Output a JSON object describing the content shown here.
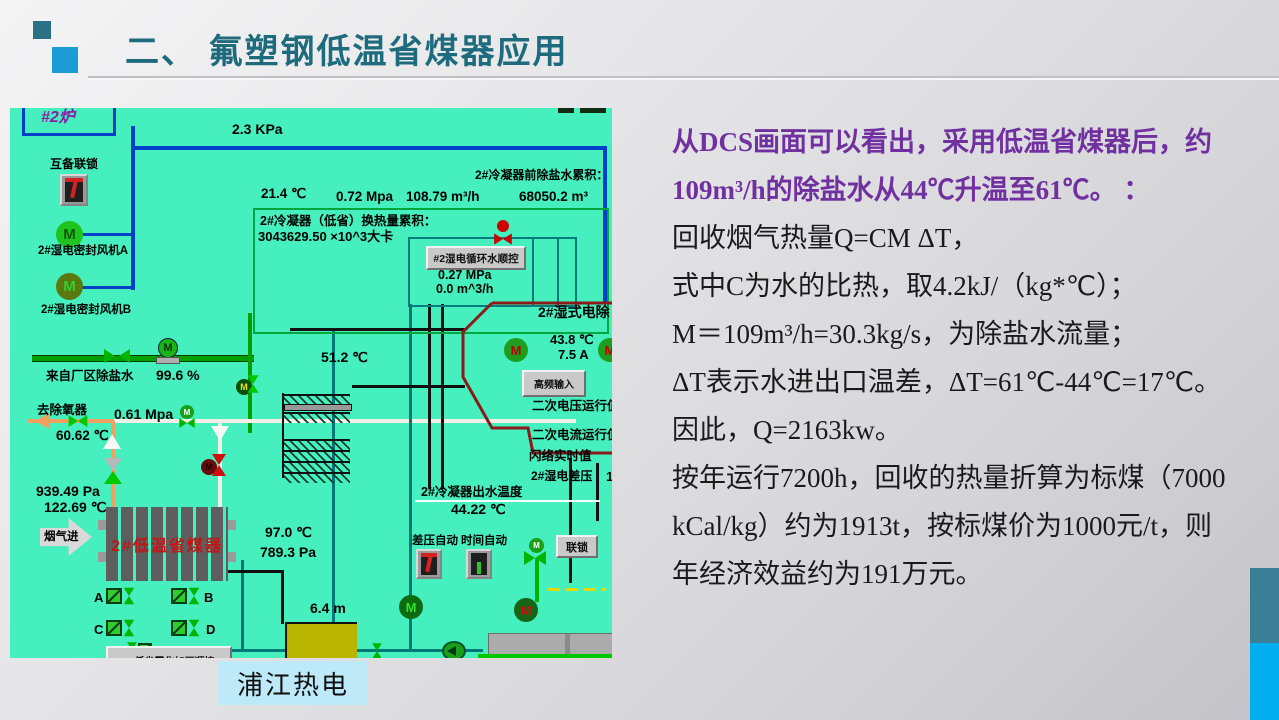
{
  "slide": {
    "title": "二、 氟塑钢低温省煤器应用",
    "caption": "浦江热电",
    "colors": {
      "title": "#1D6B7D",
      "body_highlight": "#7030A0",
      "dcs_background": "#45EFBE",
      "caption_background": "#BDE9F8",
      "deco_teal": "#3A7F96",
      "deco_blue": "#00AEEF",
      "accent_square_blue": "#1C9BD5"
    }
  },
  "body": {
    "lines": [
      "从DCS画面可以看出，采用低温省煤器后，约",
      "109m³/h的除盐水从44℃升温至61℃。 ：",
      "回收烟气热量Q=CM ΔT，",
      "式中C为水的比热，取4.2kJ/（kg*℃）；",
      "M＝109m³/h=30.3kg/s，为除盐水流量；",
      "ΔT表示水进出口温差，ΔT=61℃-44℃=17℃。",
      "因此，Q=2163kw。",
      "按年运行7200h，回收的热量折算为标煤（7000",
      "kCal/kg）约为1913t，按标煤价为1000元/t，则",
      "年经济效益约为191万元。"
    ]
  },
  "dcs": {
    "unit_tag": "#2炉",
    "kpa_top": "2.3 KPa",
    "interlock_a": "互备联锁",
    "fan_a": "2#湿电密封风机A",
    "fan_b": "2#湿电密封风机B",
    "temp_top": "21.4 ℃",
    "mpa_top": "0.72 Mpa",
    "flow_top": "108.79 m³/h",
    "vol_top": "68050.2 m³",
    "accum_pre": "2#冷凝器前除盐水累积：",
    "accum_heat_title": "2#冷凝器（低省）换热量累积：",
    "accum_heat_value": "3043629.50 ×10^3大卡",
    "seq_button": "#2湿电循环水顺控",
    "mpa_inner": "0.27 MPa",
    "flow_inner": "0.0 m^3/h",
    "from_plant": "来自厂区除盐水",
    "percent": "99.6 %",
    "to_deaerator": "去除氧器",
    "mpa_mid": "0.61 Mpa",
    "temp_6062": "60.62 ℃",
    "pa_939": "939.49 Pa",
    "temp_12269": "122.69 ℃",
    "flue_in": "烟气进",
    "economizer": "2#低温省煤器",
    "temp_512": "51.2 ℃",
    "esp_title": "2#湿式电除",
    "temp_438": "43.8 ℃",
    "amp_75": "7.5 A",
    "hf_button": "高频输入",
    "sec_voltage": "二次电压运行值",
    "sec_current": "二次电流运行值",
    "flash_value": "闪络实时值",
    "dp_label": "2#湿电差压",
    "dp_digit": "1",
    "outlet_label": "2#冷凝器出水温度",
    "outlet_value": "44.22 ℃",
    "dp_auto": "差压自动",
    "time_auto": "时间自动",
    "interlock_b": "联锁",
    "temp_970": "97.0 ℃",
    "pa_7893": "789.3 Pa",
    "level_64": "6.4 m",
    "valve_a": "A",
    "valve_b": "B",
    "valve_c": "C",
    "valve_d": "D",
    "bottom_button": "2#低省雾化加压顺控",
    "motor_letter": "M"
  }
}
